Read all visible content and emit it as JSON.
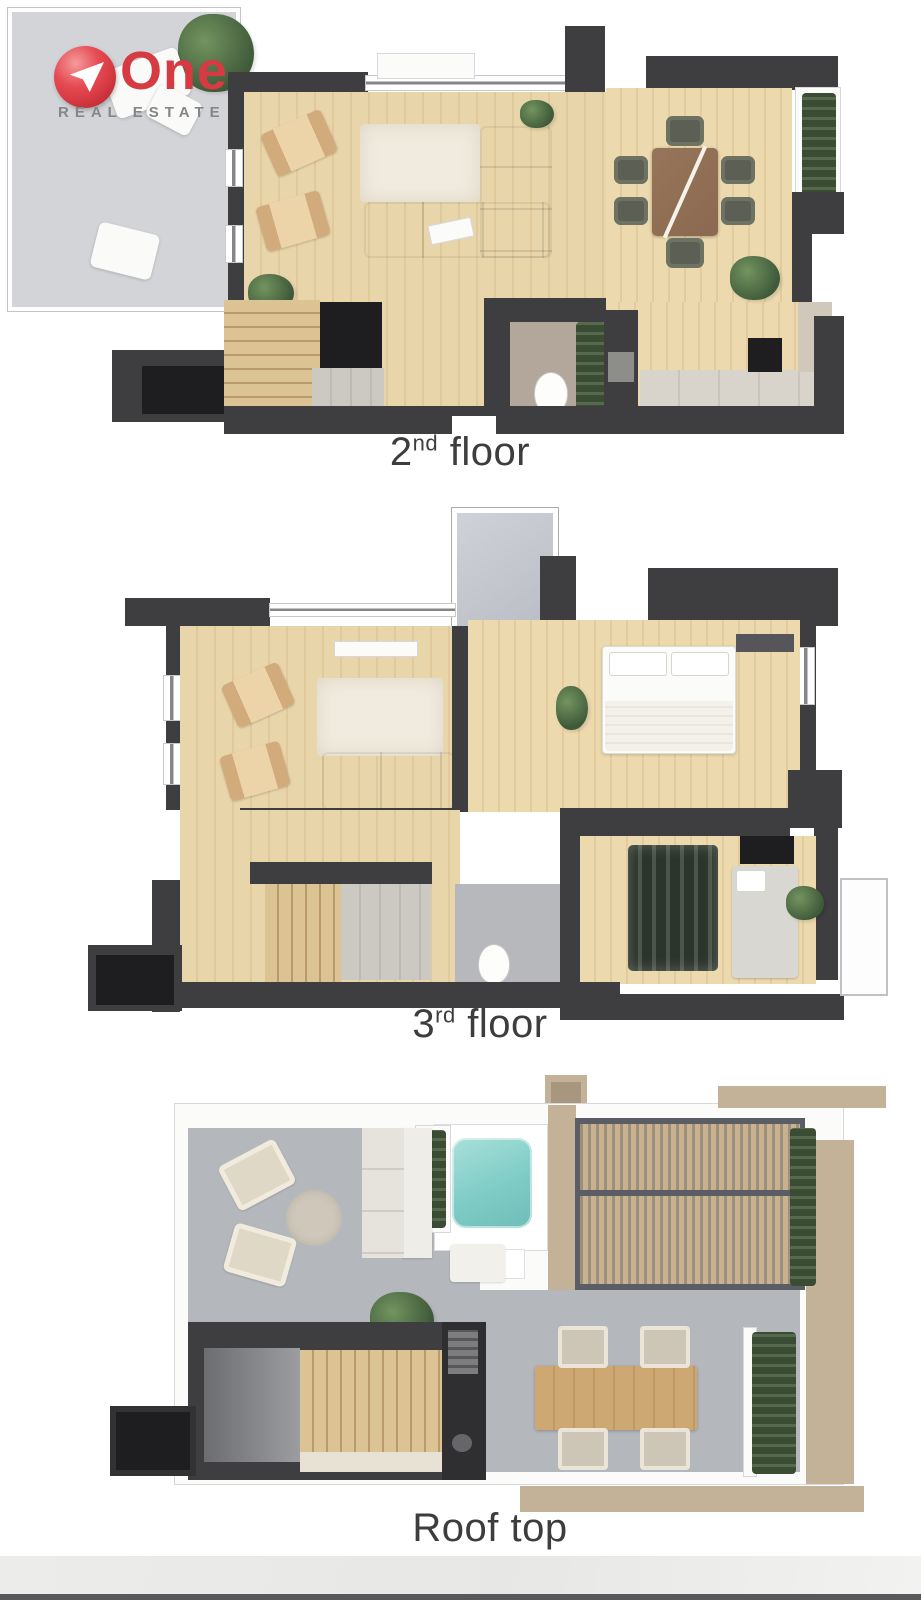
{
  "logo": {
    "brand": "One",
    "tagline": "REAL ESTATE"
  },
  "floors": [
    {
      "id": "second-floor",
      "base": "2",
      "sup": "nd",
      "rest": " floor"
    },
    {
      "id": "third-floor",
      "base": "3",
      "sup": "rd",
      "rest": " floor"
    },
    {
      "id": "roof-top",
      "base": "Roof top",
      "sup": "",
      "rest": ""
    }
  ],
  "colors": {
    "brand_red": "#d63a42",
    "tagline_gray": "#85858a",
    "wall": "#3e3e41",
    "wall_dark": "#1e1e20",
    "wood_floor": "#e8d5a9",
    "terrace_gray": "#d2d4d8",
    "roof_gray": "#b4b8bd",
    "rug_cream": "#f1ebdf",
    "sofa_sage": "#a9ad97",
    "table_wood": "#8a6950",
    "dining_chair": "#5b5f54",
    "plant_green": "#4c6847",
    "pool_teal": "#7fccc6",
    "pergola_wood": "#c8b18c",
    "pergola_frame": "#5a5d63",
    "beige_trim": "#c3b298",
    "hedge_green": "#44523c",
    "counter_gray": "#d8d4cb",
    "bath_floor": "#b3a79b",
    "stairs_wood": "#dbc394",
    "label_text": "#3d3d3f"
  }
}
